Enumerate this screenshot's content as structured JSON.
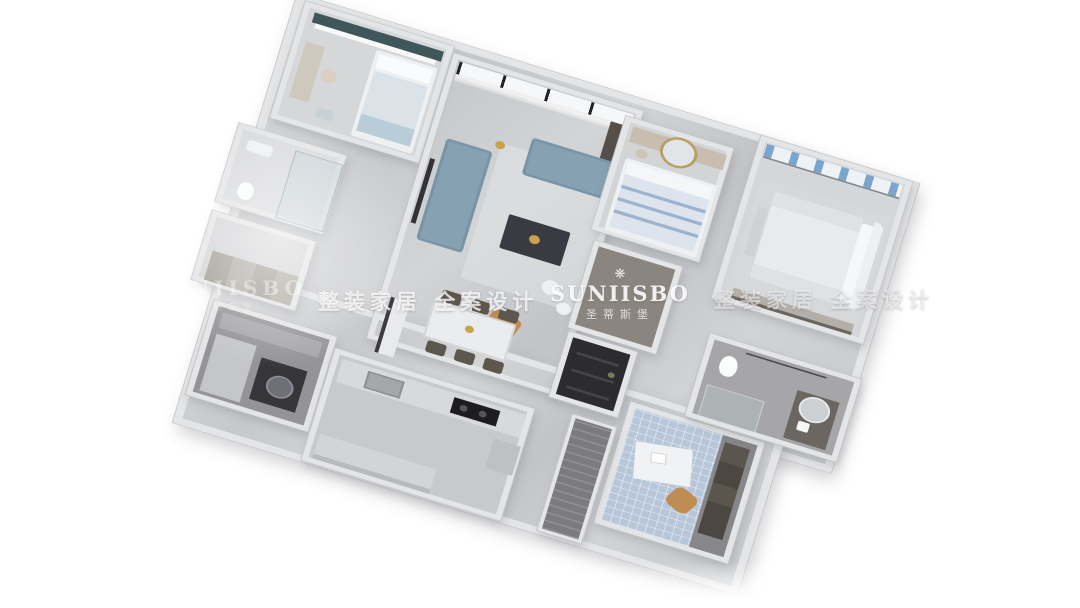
{
  "render": {
    "type": "3d-isometric-floorplan",
    "subject": "apartment dollhouse top view render",
    "background": "#ffffff"
  },
  "watermarks": {
    "brand": "SUNIISBO",
    "brand_cn": "圣蒂斯堡",
    "slogan": "整装家居 全案设计",
    "crown_icon": "❋"
  },
  "palette": {
    "wall": "#e4e5e6",
    "wall_edge": "#c6c7c9",
    "floor_marble": "#cdcfd1",
    "floor_hallway": "#8a857e",
    "floor_tile_blue": "#b7c6d8",
    "sofa_blue": "#85a1b2",
    "accent_tan": "#bf8c52",
    "curtain_teal": "#3f575b",
    "curtain_blue_stripe": "#7aa6ce",
    "dark_pantry": "#2c2c30",
    "coffee_table": "#3a3a42",
    "gold_decor": "#c9a24a"
  },
  "rooms": [
    {
      "name": "secondary-bedroom"
    },
    {
      "name": "living-room"
    },
    {
      "name": "dining-area"
    },
    {
      "name": "guest-bedroom"
    },
    {
      "name": "master-bedroom"
    },
    {
      "name": "bathroom-1"
    },
    {
      "name": "cloakroom"
    },
    {
      "name": "laundry-room"
    },
    {
      "name": "kitchen"
    },
    {
      "name": "hallway"
    },
    {
      "name": "pantry"
    },
    {
      "name": "study"
    },
    {
      "name": "master-bathroom"
    },
    {
      "name": "balcony"
    }
  ]
}
